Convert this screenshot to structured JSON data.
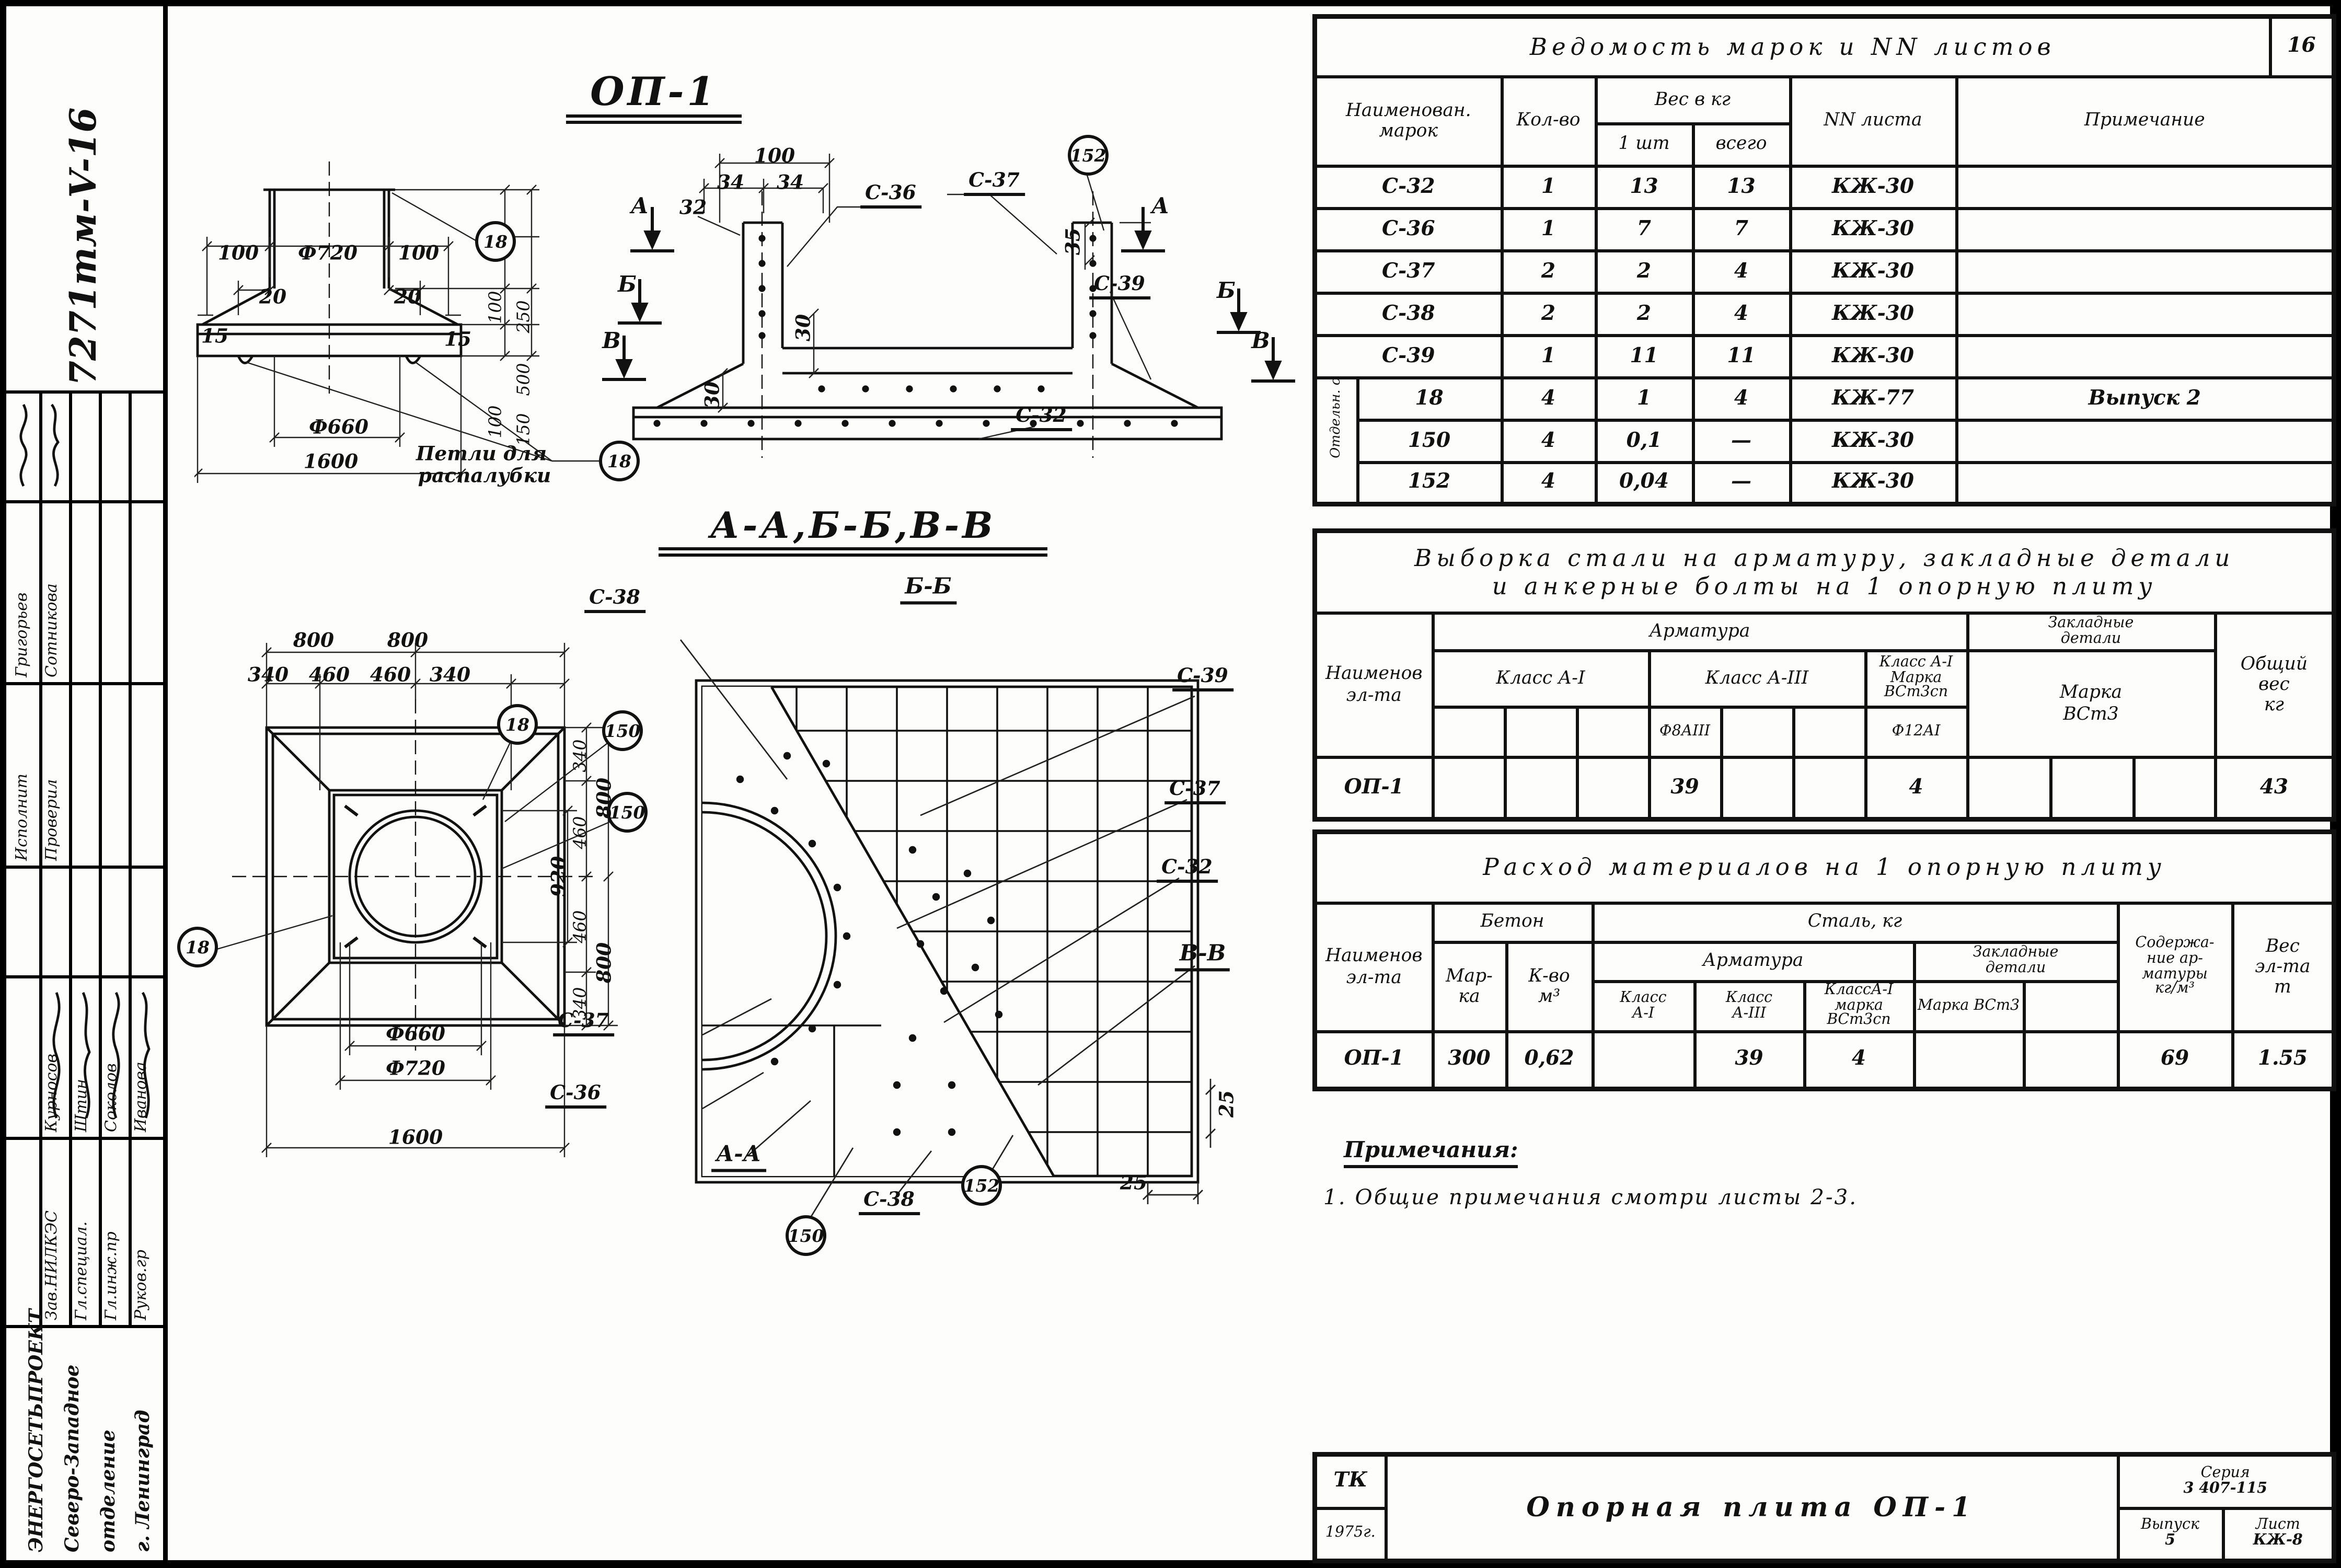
{
  "page": {
    "sheet_no": "16"
  },
  "sidebar": {
    "doc_number": "7271тм-V-16",
    "stamp_a": [
      {
        "role": "Исполнит",
        "name": "Григорьев"
      },
      {
        "role": "Проверил",
        "name": "Сотникова"
      }
    ],
    "stamp_b": [
      {
        "role": "Зав.НИЛКЭС",
        "name": "Курносов"
      },
      {
        "role": "Гл.специал.",
        "name": "Штин"
      },
      {
        "role": "Гл.инж.пр",
        "name": "Соколов"
      },
      {
        "role": "Руков.гр",
        "name": "Иванова"
      }
    ],
    "org_lines": [
      "ЭНЕРГОСЕТЬПРОЕКТ",
      "Северо-Западное",
      "отделение",
      "г. Ленинград"
    ]
  },
  "marks_table": {
    "title": "Ведомость марок и NN листов",
    "col_name": "Наименован. марок",
    "col_qty": "Кол-во",
    "col_weight": "Вес в кг",
    "col_w_one": "1 шт",
    "col_w_all": "всего",
    "col_sheet": "NN листа",
    "col_note": "Примечание",
    "group_label": "Отдельн. стержни",
    "rows": [
      [
        "С-32",
        "1",
        "13",
        "13",
        "КЖ-30",
        ""
      ],
      [
        "С-36",
        "1",
        "7",
        "7",
        "КЖ-30",
        ""
      ],
      [
        "С-37",
        "2",
        "2",
        "4",
        "КЖ-30",
        ""
      ],
      [
        "С-38",
        "2",
        "2",
        "4",
        "КЖ-30",
        ""
      ],
      [
        "С-39",
        "1",
        "11",
        "11",
        "КЖ-30",
        ""
      ],
      [
        "18",
        "4",
        "1",
        "4",
        "КЖ-77",
        "Выпуск 2"
      ],
      [
        "150",
        "4",
        "0,1",
        "—",
        "КЖ-30",
        ""
      ],
      [
        "152",
        "4",
        "0,04",
        "—",
        "КЖ-30",
        ""
      ]
    ]
  },
  "steel_table": {
    "title_line1": "Выборка стали на арматуру, закладные детали",
    "title_line2": "и анкерные болты на 1 опорную плиту",
    "name_lines": [
      "Наименов",
      "эл-та"
    ],
    "grp_armature": "Арматура",
    "embed_lines": [
      "Закладные",
      "детали"
    ],
    "cl_a1": "Класс А-I",
    "cl_a3": "Класс А-III",
    "a1m_lines": [
      "Класс А-I",
      "Марка",
      "ВСт3сп"
    ],
    "embed_mark_lines": [
      "Марка",
      "ВСт3"
    ],
    "sub_f8": "Ф8АIII",
    "sub_f12": "Ф12АI",
    "total_lines": [
      "Общий",
      "вес",
      "кг"
    ],
    "row": {
      "name": "ОП-1",
      "f8": "39",
      "f12": "4",
      "total": "43"
    }
  },
  "materials_table": {
    "title": "Расход материалов на 1 опорную плиту",
    "name_lines": [
      "Наименов",
      "эл-та"
    ],
    "grp_concrete": "Бетон",
    "mark_lines": [
      "Мар-",
      "ка"
    ],
    "vol_lines": [
      "К-во",
      "м³"
    ],
    "grp_steel": "Сталь, кг",
    "grp_armature": "Арматура",
    "a1_lines": [
      "Класс",
      "А-I"
    ],
    "a3_lines": [
      "Класс",
      "А-III"
    ],
    "a1m_lines": [
      "КлассА-I",
      "марка",
      "ВСт3сп"
    ],
    "embed_lines": [
      "Закладные",
      "детали"
    ],
    "embed_mark": "Марка ВСт3",
    "content_lines": [
      "Содержа-",
      "ние ар-",
      "матуры",
      "кг/м³"
    ],
    "weight_lines": [
      "Вес",
      "эл-та",
      "т"
    ],
    "row": {
      "name": "ОП-1",
      "mark": "300",
      "vol": "0,62",
      "a1": "",
      "a3": "39",
      "a1m": "4",
      "embed1": "",
      "embed2": "",
      "content": "69",
      "weight": "1.55"
    }
  },
  "notes": {
    "title": "Примечания:",
    "item1": "1. Общие примечания смотри листы 2-3."
  },
  "titleblock": {
    "tk": "ТК",
    "year": "1975г.",
    "title": "Опорная плита ОП-1",
    "series_label": "Серия",
    "series": "3 407-115",
    "issue_label": "Выпуск",
    "issue": "5",
    "sheet_label": "Лист",
    "sheet": "КЖ-8"
  },
  "drawings": {
    "elev_title": "ОП-1",
    "section_heading": "А-А,Б-Б,В-В",
    "elev": {
      "d100l": "100",
      "d720": "Ф720",
      "d100r": "100",
      "d20l": "20",
      "d20r": "20",
      "d15l": "15",
      "d15r": "15",
      "v100t": "100",
      "v250": "250",
      "v500": "500",
      "v100b": "100",
      "v150": "150",
      "d660": "Ф660",
      "d1600": "1600",
      "c18": "18",
      "note1": "Петли для",
      "note2": "распалубки"
    },
    "section": {
      "d100": "100",
      "d34l": "34",
      "d34r": "34",
      "d32": "32",
      "d35": "35",
      "d30a": "30",
      "d30b": "30",
      "c36": "С-36",
      "c37": "С-37",
      "c39": "С-39",
      "c32": "С-32",
      "c152": "152",
      "mA": "А",
      "mB": "Б",
      "mV": "В"
    },
    "plan": {
      "t800l": "800",
      "t800r": "800",
      "t340l": "340",
      "t460l": "460",
      "t460r": "460",
      "t340r": "340",
      "r920": "920",
      "r340a": "340",
      "r460a": "460",
      "r460b": "460",
      "r340b": "340",
      "r800a": "800",
      "r800b": "800",
      "d660": "Ф660",
      "d720": "Ф720",
      "d1600": "1600",
      "c18": "18",
      "c150": "150"
    },
    "bigplan": {
      "bb": "Б-Б",
      "aa": "А-А",
      "vv": "В-В",
      "c38": "С-38",
      "c39": "С-39",
      "c37": "С-37",
      "c32": "С-32",
      "c36": "С-36",
      "c150": "150",
      "c152": "152",
      "d25": "25",
      "d25v": "25"
    }
  }
}
